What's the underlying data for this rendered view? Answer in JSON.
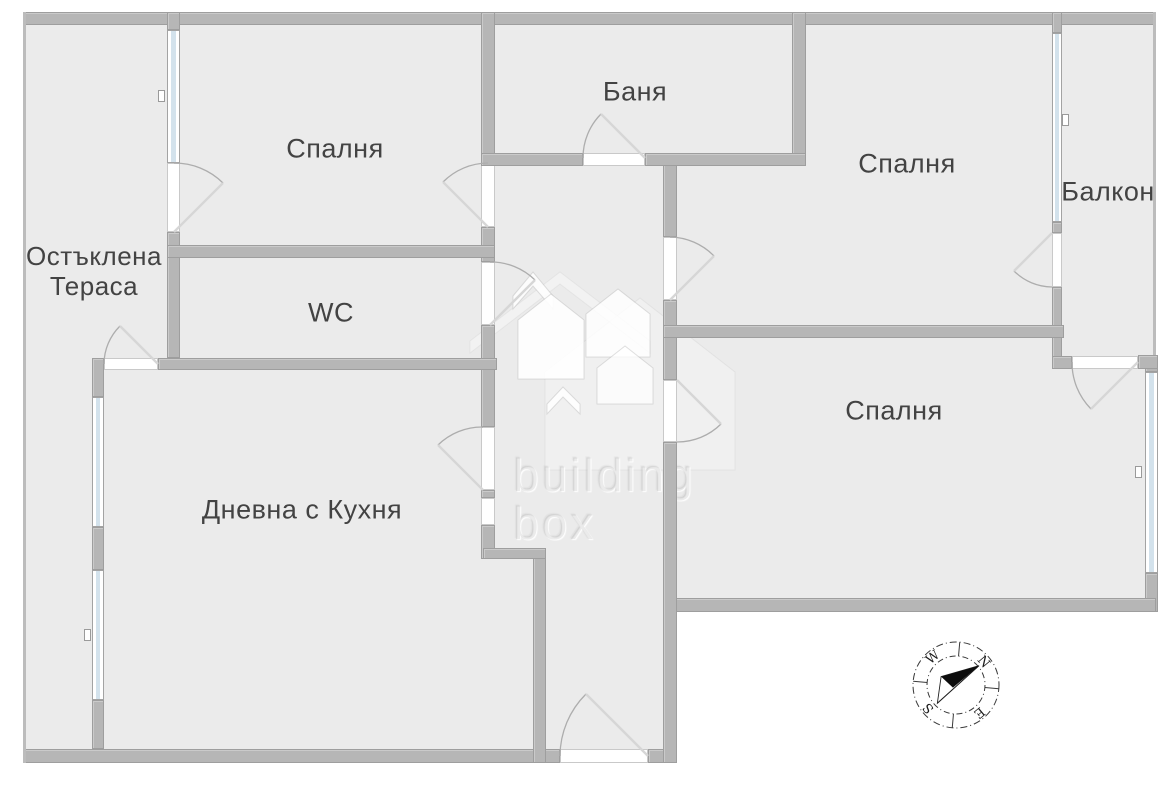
{
  "rooms": {
    "terrace": {
      "label": "Остъклена\nТераса"
    },
    "bedroom_top_left": {
      "label": "Спалня"
    },
    "bathroom": {
      "label": "Баня"
    },
    "bedroom_top_right": {
      "label": "Спалня"
    },
    "balcony": {
      "label": "Балкон"
    },
    "wc": {
      "label": "WC"
    },
    "living_kitchen": {
      "label": "Дневна с Кухня"
    },
    "bedroom_right": {
      "label": "Спалня"
    }
  },
  "watermark": {
    "line1": "building",
    "line2": "box"
  },
  "compass": {
    "north": "N",
    "east": "E",
    "south": "S",
    "west": "W"
  },
  "colors": {
    "wall": "#b6b6b6",
    "floor": "#ebebeb",
    "window_glass": "#d3e2ec",
    "label_text": "#434343",
    "outside": "#ffffff"
  }
}
